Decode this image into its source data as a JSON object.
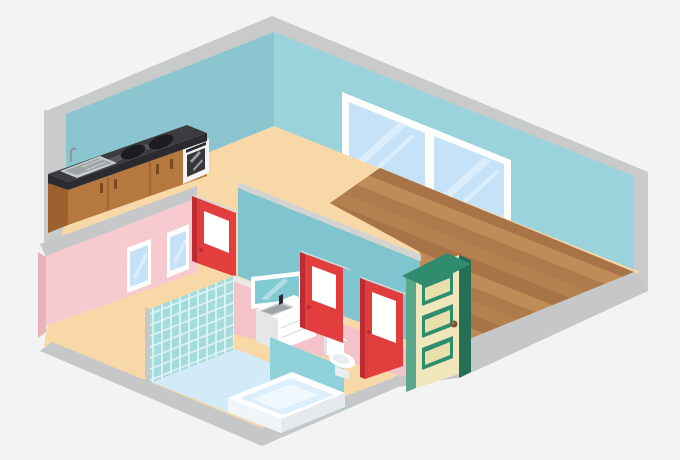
{
  "scene": {
    "title": "Isometric apartment interior cutaway illustration",
    "description": "Cutaway isometric view of an apartment: kitchen with counter, stove burners and oven along the back-left teal wall; living room with wood plank floor and a large double window on the back-right wall; front-left bathroom wing with pink walls, tiled shower wall, light blue floor, bathtub, vanity with sink, mirror and toilet; three red interior doors and one green entry door."
  },
  "inventory": {
    "rooms": [
      "kitchen",
      "living-room",
      "hallway",
      "bathroom",
      "toilet-room"
    ],
    "furniture": [
      "kitchen-counter",
      "cooktop-burners",
      "oven",
      "kitchen-sink",
      "large-window",
      "small-windows",
      "red-door-kitchen",
      "red-door-bathroom",
      "red-door-toilet",
      "green-entry-door",
      "mirror",
      "vanity-with-sink",
      "tiled-wall",
      "bathtub",
      "toilet",
      "wood-plank-floor",
      "bathroom-floor"
    ]
  },
  "colors": {
    "background": "#F2F3F2",
    "shell_gray": "#C9CACA",
    "rim_gray": "#C6C7C8",
    "wall_teal_left": "#8BC6D0",
    "wall_teal_right": "#9AD3DC",
    "floor_peach": "#F8D8A6",
    "wood_a": "#B5804F",
    "wood_b": "#A87346",
    "wood_c": "#BF8B57",
    "wood_d": "#AE794B",
    "pink_wall": "#F7CACF",
    "pink_side": "#EAB2BA",
    "pink_lower": "#F4C3C9",
    "partition_teal": "#7FC4CE",
    "partition_cap": "#D2D3D3",
    "lower_wall_cap": "#E8E9E9",
    "wc_partition_teal": "#8FD2DA",
    "tile_grout": "#DFF3F3",
    "tile_fill": "#A4DBDD",
    "tile_edge": "#C6C7C7",
    "bath_floor": "#D3EAF8",
    "white": "#FFFFFF",
    "window_glass": "#C5E2F8",
    "window_shadow": "#D8DADB",
    "mirror_glass": "#81CAD3",
    "door_red": "#E23E3E",
    "door_red_dark": "#BE2B31",
    "door_cap": "#D6D7D7",
    "door_green": "#2F8C6E",
    "door_green_dark": "#256F57",
    "door_green_light": "#5AA78B",
    "door_cream": "#F0E6BB",
    "panel_inner": "#E9DFAC",
    "knob_brown": "#7B5231",
    "counter_top": "#3C3C40",
    "counter_edge": "#2B2B2F",
    "counter_streak": "#5E5E64",
    "cabinet": "#B5793F",
    "cabinet_dark": "#9C612F",
    "handle": "#7B4A22",
    "steel": "#C7CCCF",
    "steel_dark": "#9EA5A9",
    "oven_white": "#F4F4F4",
    "oven_glass": "#36363B",
    "burner": "#1C1C1E",
    "toilet_shadow": "#E9EDEF",
    "toilet_shade": "#E0E4E6",
    "tub_inner": "#DCEFFA",
    "tub_inner_hi": "#EFF8FD",
    "tub_front": "#F2F5F7",
    "tub_front2": "#E4EAED",
    "fixture_gray": "#E6E6E6",
    "fixture_gray2": "#D9DCDD"
  }
}
